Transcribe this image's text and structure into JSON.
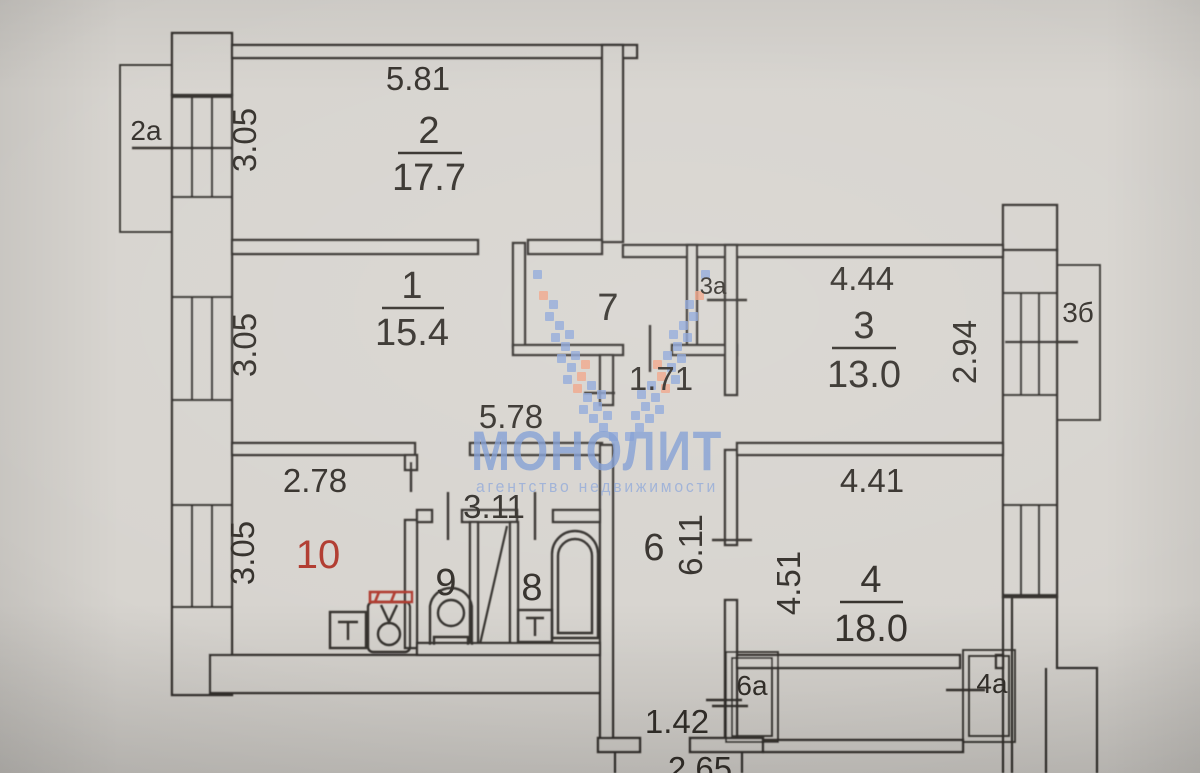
{
  "document_type": "apartment floor plan (scanned)",
  "watermark": {
    "brand": "МОНОЛИТ",
    "tagline": "агентство недвижимости",
    "logo": "pixel-wings-logo"
  },
  "rooms": {
    "r1": {
      "number": "1",
      "area": "15.4"
    },
    "r2": {
      "number": "2",
      "area": "17.7"
    },
    "r3": {
      "number": "3",
      "area": "13.0"
    },
    "r4": {
      "number": "4",
      "area": "18.0"
    },
    "r6": {
      "number": "6"
    },
    "r7": {
      "number": "7"
    },
    "r8": {
      "number": "8"
    },
    "r9": {
      "number": "9"
    },
    "r10": {
      "number": "10",
      "label_color": "#b03a2e"
    }
  },
  "dims": {
    "d581": "5.81",
    "d305_room2": "3.05",
    "d305_room1": "3.05",
    "d305_room10": "3.05",
    "d578": "5.78",
    "d171": "1.71",
    "d444": "4.44",
    "d294": "2.94",
    "d278": "2.78",
    "d311": "3.11",
    "d611": "6.11",
    "d451": "4.51",
    "d441": "4.41",
    "d142": "1.42",
    "d265": "2.65"
  },
  "annexes": {
    "a2": "2а",
    "a3": "3а",
    "b3": "3б",
    "a6": "6а",
    "a4": "4а"
  },
  "colors": {
    "paper": "#d7d4cf",
    "line": "#36332e",
    "red": "#b03a2e",
    "wm": "#7f9cd3",
    "wm-light": "#93aad8",
    "dot-blue": "#8ca5d8",
    "dot-orange": "#f0a183"
  }
}
